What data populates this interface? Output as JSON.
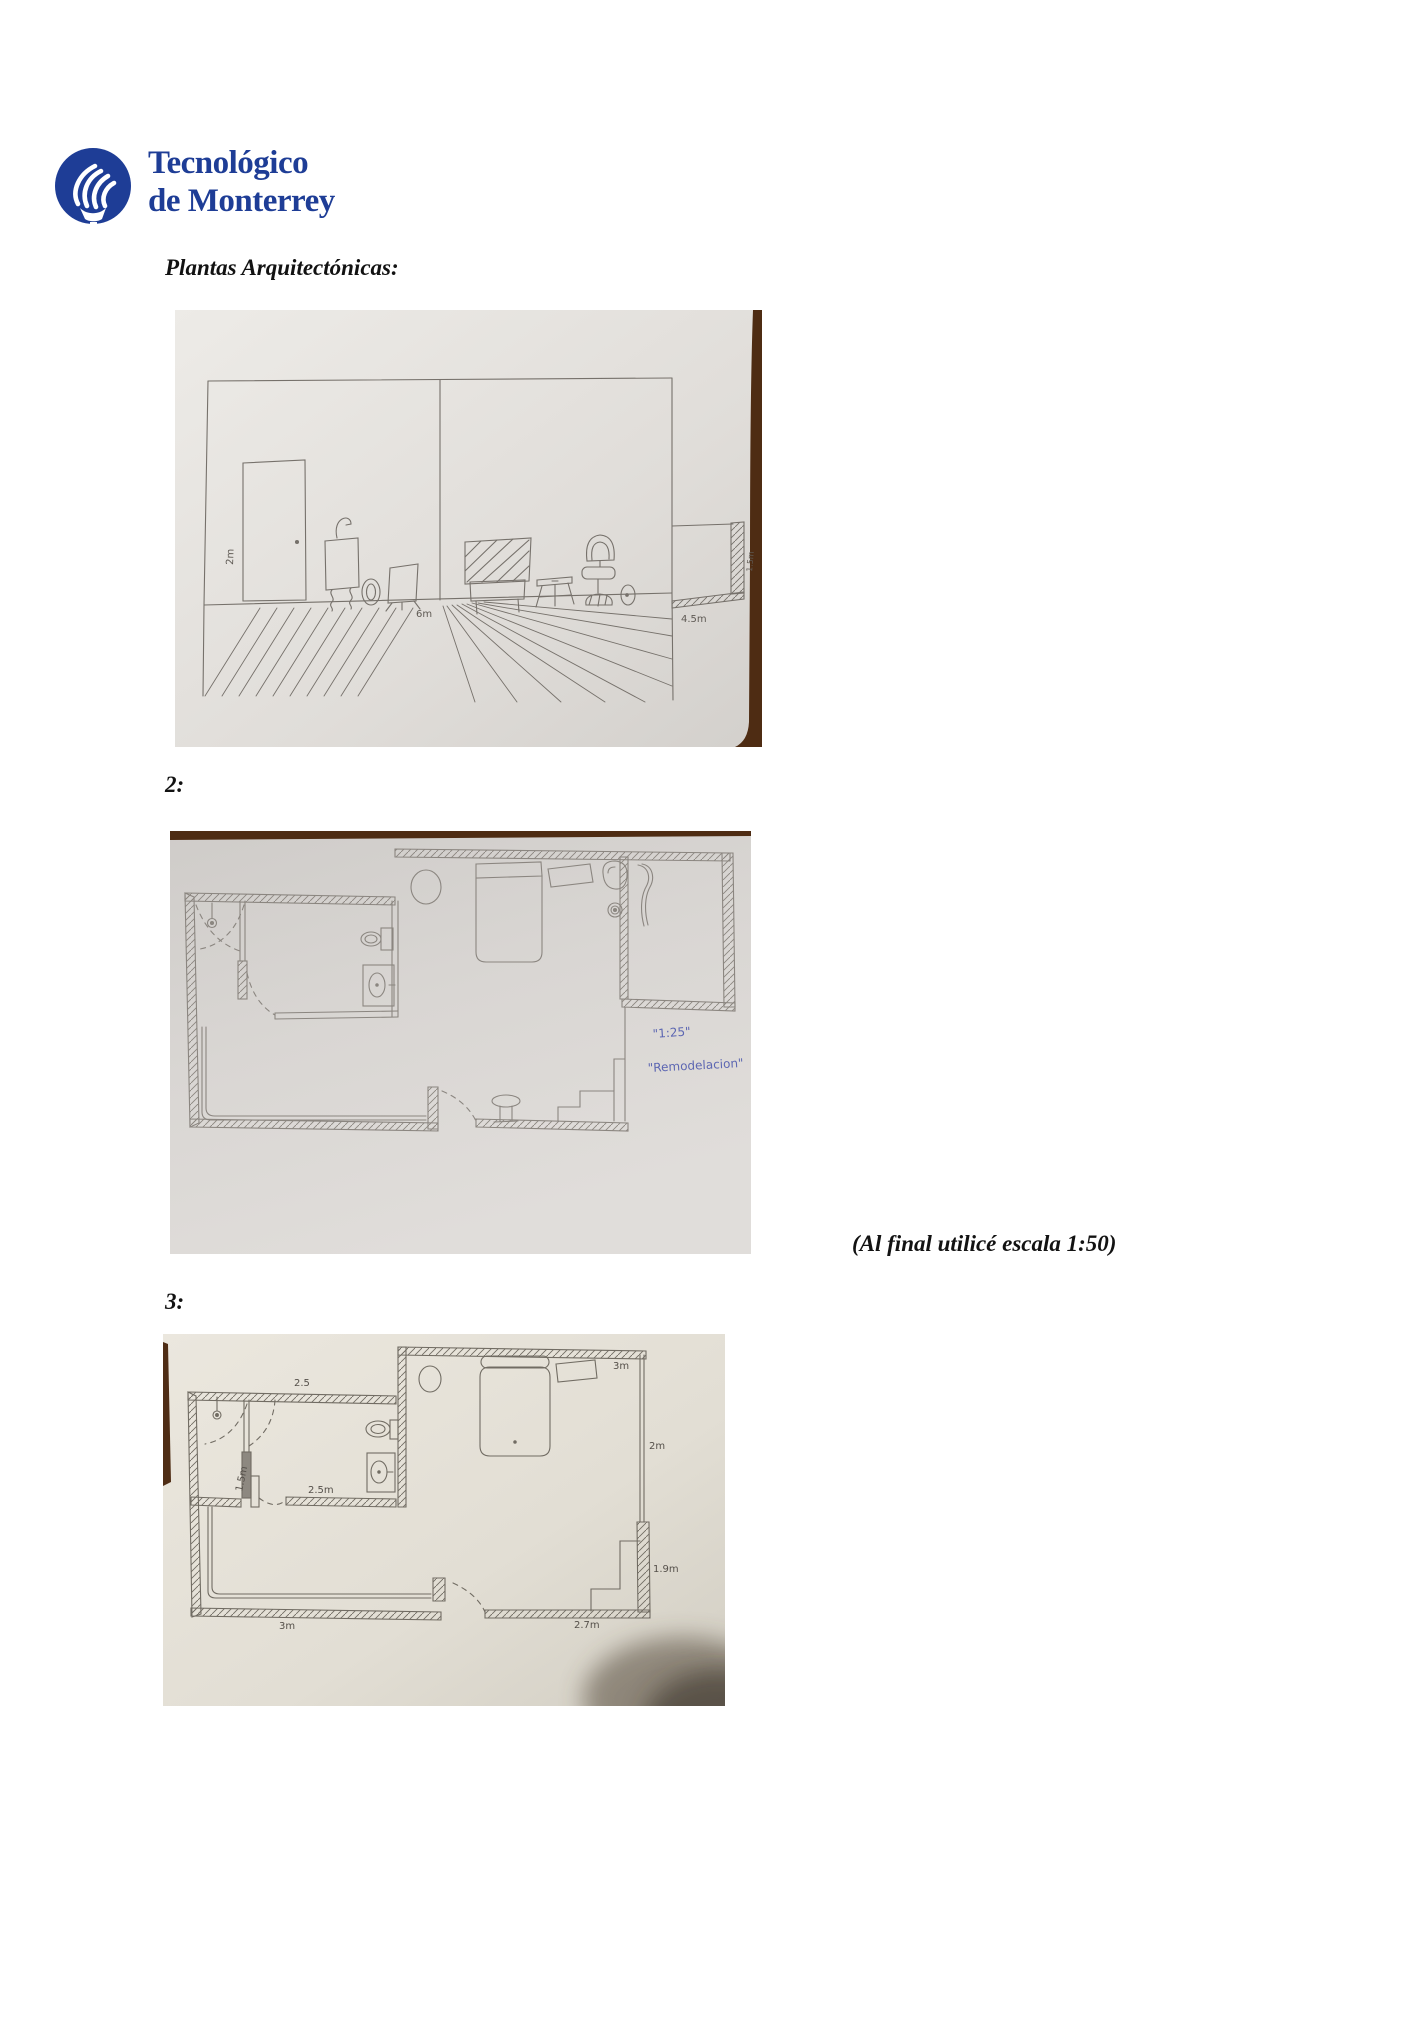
{
  "logo": {
    "line1": "Tecnológico",
    "line2": "de Monterrey",
    "color": "#1e3d96"
  },
  "heading": "Plantas Arquitectónicas:",
  "section_labels": {
    "fig2": "2:",
    "fig3": "3:"
  },
  "note": "(Al final utilicé escala 1:50)",
  "figures": {
    "fig1": {
      "labels": {
        "door_height": "2m",
        "room_width": "6m",
        "side_width": "4.5m",
        "side_wall": "1.5m"
      }
    },
    "fig2": {
      "ink_color": "#5c66b2",
      "notes": {
        "scale": "\"1:25\"",
        "caption": "\"Remodelacion\""
      }
    },
    "fig3": {
      "labels": {
        "bath_top": "2.5",
        "bed_width": "3m",
        "bed_height": "2m",
        "closet": "1.5m",
        "bath_bottom": "2.5m",
        "living_bottom": "3m",
        "bottom_right": "2.7m",
        "right_height": "1.9m"
      }
    }
  }
}
